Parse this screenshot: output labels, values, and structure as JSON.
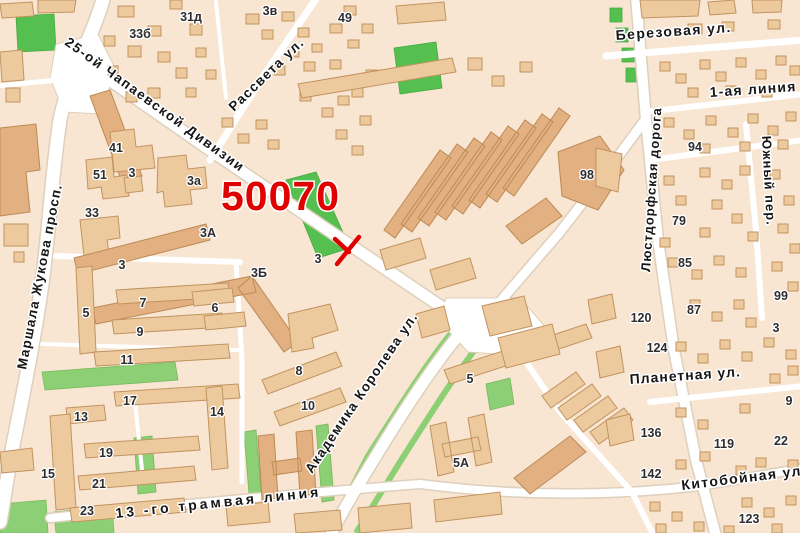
{
  "map": {
    "code_label": {
      "text": "50070",
      "color": "#e00000"
    },
    "marker": {
      "description": "red-cross-marker",
      "color": "#e00000"
    },
    "palette": {
      "background": "#f8e5d2",
      "building": "#edca9e",
      "building_outline": "#c2935f",
      "green": "#8ccf74",
      "green_bright": "#55c04f",
      "road": "#ffffff",
      "label": "#161616",
      "accent_red": "#e00000"
    },
    "street_labels": [
      {
        "text": "25-ой Чапаевской Дивизии",
        "x": 64,
        "y": 44,
        "rotate": 36,
        "size": 13.5,
        "ls": 1.6
      },
      {
        "text": "Рассвета ул.",
        "x": 234,
        "y": 112,
        "rotate": -44,
        "size": 13.5,
        "ls": 1.2
      },
      {
        "text": "Маршала Жукова просп.",
        "x": 26,
        "y": 370,
        "rotate": -79,
        "size": 13.5,
        "ls": 1.2
      },
      {
        "text": "Академика Королева ул.",
        "x": 312,
        "y": 474,
        "rotate": -56,
        "size": 13.5,
        "ls": 1.2
      },
      {
        "text": "Люстдорфская дорога",
        "x": 650,
        "y": 272,
        "rotate": -86,
        "size": 13,
        "ls": 1
      },
      {
        "text": "Южный пер.",
        "x": 762,
        "y": 136,
        "rotate": 87,
        "size": 13,
        "ls": 1
      },
      {
        "text": "Березовая ул.",
        "x": 616,
        "y": 40,
        "rotate": -4,
        "size": 14,
        "ls": 1.4
      },
      {
        "text": "1-ая линия",
        "x": 710,
        "y": 97,
        "rotate": -4,
        "size": 14,
        "ls": 1.2
      },
      {
        "text": "Планетная ул.",
        "x": 630,
        "y": 384,
        "rotate": -4,
        "size": 14,
        "ls": 1
      },
      {
        "text": "Китобойная ул.",
        "x": 682,
        "y": 490,
        "rotate": -7,
        "size": 14,
        "ls": 1.4
      },
      {
        "text": "13 -го трамвая линия",
        "x": 116,
        "y": 518,
        "rotate": -6,
        "size": 14,
        "ls": 3
      }
    ],
    "building_numbers": [
      {
        "text": "31д",
        "x": 191,
        "y": 21
      },
      {
        "text": "3в",
        "x": 270,
        "y": 15
      },
      {
        "text": "49",
        "x": 345,
        "y": 22
      },
      {
        "text": "33б",
        "x": 140,
        "y": 38
      },
      {
        "text": "41",
        "x": 116,
        "y": 152
      },
      {
        "text": "51",
        "x": 100,
        "y": 179
      },
      {
        "text": "3",
        "x": 132,
        "y": 177
      },
      {
        "text": "3а",
        "x": 194,
        "y": 185
      },
      {
        "text": "33",
        "x": 92,
        "y": 217
      },
      {
        "text": "3А",
        "x": 208,
        "y": 237
      },
      {
        "text": "3",
        "x": 122,
        "y": 269
      },
      {
        "text": "3Б",
        "x": 259,
        "y": 277
      },
      {
        "text": "3",
        "x": 318,
        "y": 263
      },
      {
        "text": "5",
        "x": 86,
        "y": 317
      },
      {
        "text": "7",
        "x": 143,
        "y": 307
      },
      {
        "text": "9",
        "x": 140,
        "y": 336
      },
      {
        "text": "6",
        "x": 215,
        "y": 312
      },
      {
        "text": "11",
        "x": 127,
        "y": 364
      },
      {
        "text": "17",
        "x": 130,
        "y": 405
      },
      {
        "text": "13",
        "x": 81,
        "y": 421
      },
      {
        "text": "14",
        "x": 217,
        "y": 416
      },
      {
        "text": "15",
        "x": 48,
        "y": 478
      },
      {
        "text": "19",
        "x": 106,
        "y": 457
      },
      {
        "text": "21",
        "x": 99,
        "y": 488
      },
      {
        "text": "23",
        "x": 87,
        "y": 515
      },
      {
        "text": "8",
        "x": 299,
        "y": 375
      },
      {
        "text": "10",
        "x": 308,
        "y": 410
      },
      {
        "text": "5",
        "x": 470,
        "y": 383
      },
      {
        "text": "5А",
        "x": 461,
        "y": 467
      },
      {
        "text": "98",
        "x": 587,
        "y": 179
      },
      {
        "text": "94",
        "x": 695,
        "y": 151
      },
      {
        "text": "79",
        "x": 679,
        "y": 225
      },
      {
        "text": "85",
        "x": 685,
        "y": 267
      },
      {
        "text": "87",
        "x": 694,
        "y": 314
      },
      {
        "text": "99",
        "x": 781,
        "y": 300
      },
      {
        "text": "3",
        "x": 776,
        "y": 332
      },
      {
        "text": "9",
        "x": 789,
        "y": 405
      },
      {
        "text": "120",
        "x": 641,
        "y": 322
      },
      {
        "text": "124",
        "x": 657,
        "y": 352
      },
      {
        "text": "136",
        "x": 651,
        "y": 437
      },
      {
        "text": "142",
        "x": 651,
        "y": 478
      },
      {
        "text": "119",
        "x": 724,
        "y": 448
      },
      {
        "text": "22",
        "x": 781,
        "y": 445
      },
      {
        "text": "123",
        "x": 749,
        "y": 523
      }
    ]
  }
}
